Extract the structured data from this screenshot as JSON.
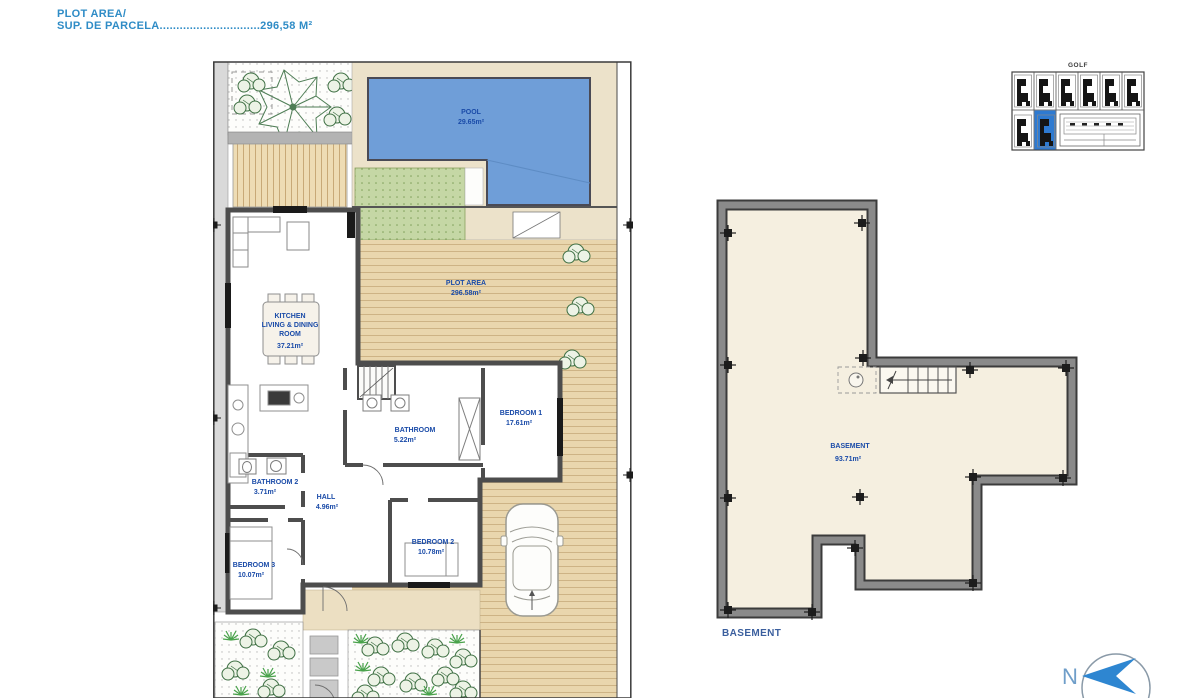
{
  "header": {
    "line1": "PLOT AREA/",
    "line2": "SUP. DE PARCELA..............................296,58 M²"
  },
  "floor_plan": {
    "pool": {
      "name": "POOL",
      "area": "29.65m²"
    },
    "plot": {
      "name": "PLOT AREA",
      "area": "296.58m²"
    },
    "kitchen": {
      "line1": "KITCHEN",
      "line2": "LIVING & DINING",
      "line3": "ROOM",
      "area": "37.21m²"
    },
    "bathroom": {
      "name": "BATHROOM",
      "area": "5.22m²"
    },
    "bathroom2": {
      "name": "BATHROOM 2",
      "area": "3.71m²"
    },
    "hall": {
      "name": "HALL",
      "area": "4.96m²"
    },
    "bedroom1": {
      "name": "BEDROOM 1",
      "area": "17.61m²"
    },
    "bedroom2": {
      "name": "BEDROOM 2",
      "area": "10.78m²"
    },
    "bedroom3": {
      "name": "BEDROOM 3",
      "area": "10.07m²"
    }
  },
  "basement": {
    "name": "BASEMENT",
    "area": "93.71m²",
    "caption": "BASEMENT"
  },
  "site_plan": {
    "title": "GOLF"
  },
  "compass": {
    "label": "N"
  },
  "colors": {
    "header_blue": "#2f8cc6",
    "label_blue": "#1a4ba8",
    "pool_blue": "#6f9ed8",
    "highlight_blue": "#2e7ad1",
    "deck_tan": "#e9d6ad",
    "wall_gray": "#4d4d4d"
  }
}
